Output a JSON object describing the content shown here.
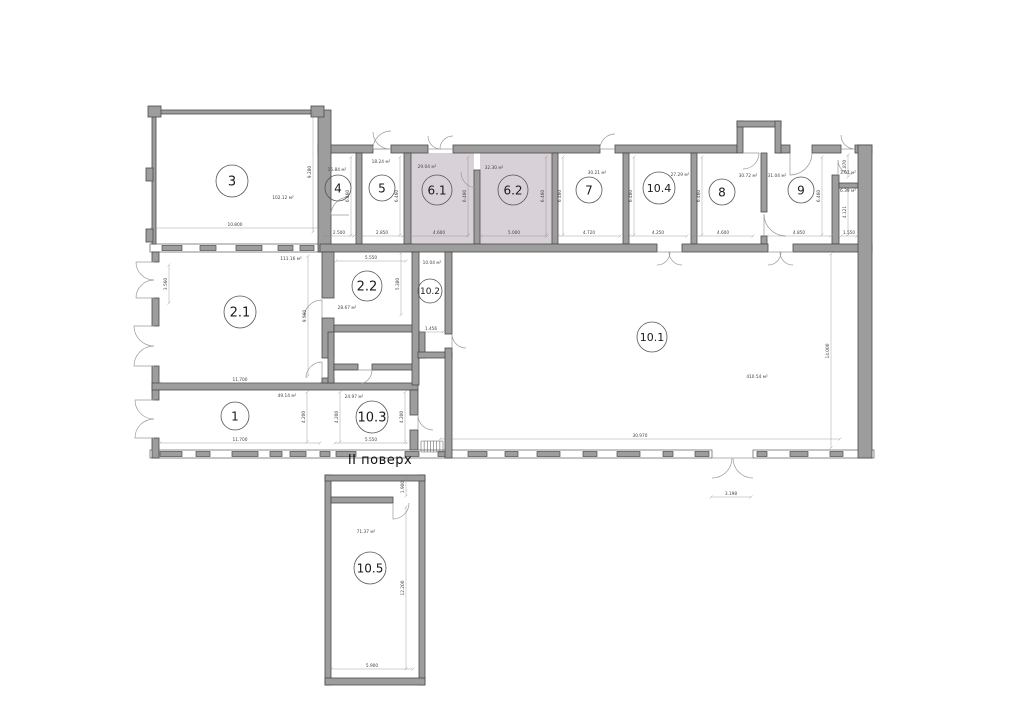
{
  "plan": {
    "floor_label": "II поверх",
    "colors": {
      "wall": "#9d9d9d",
      "wall_stroke": "#4a4a4a",
      "highlight": "#d9d1d8",
      "band_fill": "#ffffff",
      "band_stroke": "#6f6f6f",
      "door": "#9a9a9a",
      "dim": "#444444",
      "room_stroke": "#555555",
      "text": "#1a1a1a"
    },
    "rooms": [
      {
        "number": "3",
        "area": "102.12 м²",
        "circle": [
          232,
          181,
          16,
          13
        ],
        "area_pos": [
          283,
          199
        ]
      },
      {
        "number": "4",
        "area": "15.84 м²",
        "circle": [
          338,
          188,
          13,
          12
        ],
        "area_pos": [
          337,
          171
        ]
      },
      {
        "number": "5",
        "area": "18.24 м²",
        "circle": [
          382,
          188,
          13,
          12
        ],
        "area_pos": [
          381,
          163
        ]
      },
      {
        "number": "6.1",
        "area": "29.04 м²",
        "circle": [
          437,
          190,
          15,
          12
        ],
        "area_pos": [
          427,
          168
        ]
      },
      {
        "number": "6.2",
        "area": "32.30 м²",
        "circle": [
          513,
          190,
          15,
          12
        ],
        "area_pos": [
          494,
          169
        ]
      },
      {
        "number": "7",
        "area": "30.21 м²",
        "circle": [
          589,
          190,
          13,
          12
        ],
        "area_pos": [
          597,
          174
        ]
      },
      {
        "number": "10.4",
        "area": "27.29 м²",
        "circle": [
          659,
          188,
          16,
          11
        ],
        "area_pos": [
          680,
          176
        ]
      },
      {
        "number": "8",
        "area": "30.72 м²",
        "circle": [
          722,
          192,
          13,
          12
        ],
        "area_pos": [
          748,
          177
        ]
      },
      {
        "number": "9",
        "area": "31.04 м²",
        "circle": [
          801,
          190,
          13,
          12
        ],
        "area_pos": [
          777,
          177
        ]
      },
      {
        "number": "2.1",
        "area": "111.16 м²",
        "circle": [
          240,
          312,
          16,
          13
        ],
        "area_pos": [
          291,
          260
        ]
      },
      {
        "number": "2.2",
        "area": "28.67 м²",
        "circle": [
          367,
          286,
          15,
          13
        ],
        "area_pos": [
          347,
          309
        ]
      },
      {
        "number": "10.2",
        "area": "10.04 м²",
        "circle": [
          430,
          291,
          12,
          9
        ],
        "area_pos": [
          432,
          264
        ]
      },
      {
        "number": "1",
        "area": "49.14 м²",
        "circle": [
          235,
          416,
          14,
          12
        ],
        "area_pos": [
          287,
          397
        ]
      },
      {
        "number": "10.3",
        "area": "24.97 м²",
        "circle": [
          372,
          417,
          16,
          13
        ],
        "area_pos": [
          354,
          398
        ]
      },
      {
        "number": "10.1",
        "area": "410.54 м²",
        "circle": [
          652,
          337,
          15,
          11
        ],
        "area_pos": [
          757,
          378
        ]
      },
      {
        "number": "10.5",
        "area": "71.37 м²",
        "circle": [
          370,
          568,
          16,
          12
        ],
        "area_pos": [
          366,
          533
        ]
      }
    ],
    "extra_areas": [
      {
        "area": "3.07 м²",
        "pos": [
          848,
          174
        ]
      },
      {
        "area": "6.39 м²",
        "pos": [
          848,
          192
        ]
      }
    ],
    "fills": [
      [
        411,
        153,
        63,
        91
      ],
      [
        480,
        153,
        72,
        91
      ]
    ],
    "walls": [
      [
        318,
        145,
        55,
        8
      ],
      [
        391,
        145,
        37,
        8
      ],
      [
        453,
        145,
        147,
        8
      ],
      [
        615,
        145,
        122,
        8
      ],
      [
        777,
        145,
        13,
        8
      ],
      [
        812,
        145,
        29,
        8
      ],
      [
        855,
        145,
        17,
        8
      ],
      [
        737,
        121,
        6,
        32
      ],
      [
        737,
        121,
        44,
        6
      ],
      [
        775,
        121,
        6,
        32
      ],
      [
        356,
        153,
        6,
        91
      ],
      [
        404,
        153,
        7,
        91
      ],
      [
        474,
        170,
        6,
        74
      ],
      [
        552,
        153,
        6,
        91
      ],
      [
        623,
        153,
        6,
        91
      ],
      [
        691,
        153,
        6,
        91
      ],
      [
        761,
        153,
        6,
        59
      ],
      [
        761,
        236,
        6,
        8
      ],
      [
        832,
        175,
        7,
        69
      ],
      [
        839,
        183,
        19,
        5
      ],
      [
        318,
        110,
        13,
        142
      ],
      [
        152,
        110,
        166,
        4
      ],
      [
        152,
        114,
        4,
        130
      ],
      [
        148,
        106,
        13,
        11
      ],
      [
        311,
        106,
        13,
        11
      ],
      [
        146,
        168,
        7,
        13
      ],
      [
        146,
        229,
        7,
        13
      ],
      [
        320,
        244,
        337,
        8
      ],
      [
        682,
        244,
        86,
        8
      ],
      [
        793,
        244,
        79,
        8
      ],
      [
        152,
        252,
        7,
        10
      ],
      [
        152,
        298,
        7,
        28
      ],
      [
        152,
        366,
        7,
        34
      ],
      [
        152,
        438,
        7,
        20
      ],
      [
        152,
        383,
        266,
        7
      ],
      [
        322,
        252,
        12,
        46
      ],
      [
        322,
        318,
        12,
        40
      ],
      [
        322,
        378,
        12,
        5
      ],
      [
        328,
        332,
        6,
        51
      ],
      [
        334,
        364,
        24,
        6
      ],
      [
        372,
        364,
        46,
        6
      ],
      [
        334,
        325,
        84,
        7
      ],
      [
        412,
        252,
        7,
        133
      ],
      [
        419,
        332,
        6,
        26
      ],
      [
        418,
        352,
        34,
        6
      ],
      [
        445,
        252,
        7,
        82
      ],
      [
        445,
        348,
        7,
        110
      ],
      [
        410,
        390,
        8,
        25
      ],
      [
        410,
        430,
        8,
        20
      ],
      [
        858,
        145,
        14,
        313
      ],
      [
        325,
        475,
        6,
        210
      ],
      [
        419,
        475,
        6,
        210
      ],
      [
        325,
        475,
        100,
        6
      ],
      [
        325,
        678,
        100,
        7
      ],
      [
        331,
        497,
        62,
        6
      ]
    ],
    "bands": [
      [
        150,
        244,
        170,
        8
      ],
      [
        150,
        450,
        562,
        8
      ],
      [
        753,
        450,
        121,
        8
      ]
    ],
    "windows": [
      [
        162,
        245.5,
        20,
        5
      ],
      [
        200,
        245.5,
        16,
        5
      ],
      [
        236,
        245.5,
        26,
        5
      ],
      [
        278,
        245.5,
        15,
        5
      ],
      [
        300,
        245.5,
        14,
        5
      ],
      [
        160,
        451.5,
        22,
        5
      ],
      [
        196,
        451.5,
        14,
        5
      ],
      [
        232,
        451.5,
        26,
        5
      ],
      [
        270,
        451.5,
        12,
        5
      ],
      [
        290,
        451.5,
        16,
        5
      ],
      [
        320,
        451.5,
        10,
        5
      ],
      [
        336,
        451.5,
        20,
        5
      ],
      [
        405,
        451.5,
        14,
        5
      ],
      [
        438,
        451.5,
        13,
        5
      ],
      [
        468,
        451.5,
        19,
        5
      ],
      [
        505,
        451.5,
        13,
        5
      ],
      [
        537,
        451.5,
        23,
        5
      ],
      [
        583,
        451.5,
        14,
        5
      ],
      [
        617,
        451.5,
        23,
        5
      ],
      [
        663,
        451.5,
        10,
        5
      ],
      [
        695,
        451.5,
        14,
        5
      ],
      [
        757,
        451.5,
        10,
        5
      ],
      [
        790,
        451.5,
        18,
        5
      ],
      [
        830,
        451.5,
        13,
        5
      ]
    ],
    "arcs": [
      [
        154,
        262,
        18,
        180,
        90
      ],
      [
        154,
        298,
        18,
        180,
        270
      ],
      [
        154,
        326,
        20,
        180,
        90
      ],
      [
        154,
        366,
        20,
        180,
        270
      ],
      [
        154,
        400,
        19,
        180,
        90
      ],
      [
        154,
        438,
        19,
        180,
        270
      ],
      [
        373,
        149,
        17,
        0,
        270
      ],
      [
        391,
        149,
        18,
        180,
        270
      ],
      [
        428,
        149,
        13,
        0,
        270
      ],
      [
        453,
        149,
        13,
        180,
        270
      ],
      [
        615,
        149,
        15,
        180,
        270
      ],
      [
        841,
        149,
        14,
        0,
        270
      ],
      [
        743,
        153,
        16,
        0,
        90
      ],
      [
        657,
        252,
        13,
        0,
        90
      ],
      [
        682,
        252,
        13,
        180,
        90
      ],
      [
        768,
        252,
        13,
        0,
        90
      ],
      [
        793,
        252,
        13,
        180,
        90
      ],
      [
        712,
        458,
        20,
        0,
        90
      ],
      [
        753,
        458,
        20,
        180,
        90
      ],
      [
        349,
        215,
        18,
        180,
        270
      ],
      [
        322,
        318,
        18,
        270,
        180
      ],
      [
        322,
        378,
        16,
        270,
        180
      ],
      [
        358,
        370,
        14,
        0,
        90
      ],
      [
        452,
        348,
        14,
        270,
        0
      ],
      [
        418,
        430,
        15,
        270,
        0
      ],
      [
        790,
        153,
        22,
        90,
        0
      ],
      [
        838,
        174,
        14,
        270,
        0
      ],
      [
        477,
        172,
        16,
        90,
        180
      ],
      [
        393,
        503,
        16,
        90,
        0
      ],
      [
        764,
        236,
        22,
        270,
        0
      ]
    ],
    "dims": [
      {
        "t": "10.800",
        "x": 235,
        "y": 226,
        "len": 168,
        "v": false
      },
      {
        "t": "9.280",
        "x": 311,
        "y": 172,
        "len": 120,
        "v": true
      },
      {
        "t": "2.500",
        "x": 339,
        "y": 234,
        "len": 30,
        "v": false
      },
      {
        "t": "2.850",
        "x": 382,
        "y": 234,
        "len": 42,
        "v": false
      },
      {
        "t": "4.600",
        "x": 439,
        "y": 234,
        "len": 58,
        "v": false
      },
      {
        "t": "5.000",
        "x": 514,
        "y": 234,
        "len": 66,
        "v": false
      },
      {
        "t": "4.720",
        "x": 589,
        "y": 234,
        "len": 62,
        "v": false
      },
      {
        "t": "4.250",
        "x": 658,
        "y": 234,
        "len": 58,
        "v": false
      },
      {
        "t": "4.600",
        "x": 723,
        "y": 234,
        "len": 60,
        "v": false
      },
      {
        "t": "4.850",
        "x": 799,
        "y": 234,
        "len": 64,
        "v": false
      },
      {
        "t": "1.550",
        "x": 849,
        "y": 234,
        "len": 16,
        "v": false
      },
      {
        "t": "6.460",
        "x": 349,
        "y": 196,
        "len": 78,
        "v": true
      },
      {
        "t": "6.460",
        "x": 398,
        "y": 196,
        "len": 78,
        "v": true
      },
      {
        "t": "6.460",
        "x": 466,
        "y": 196,
        "len": 78,
        "v": true
      },
      {
        "t": "6.460",
        "x": 544,
        "y": 196,
        "len": 78,
        "v": true
      },
      {
        "t": "6.460",
        "x": 561,
        "y": 196,
        "len": 78,
        "v": true
      },
      {
        "t": "6.460",
        "x": 632,
        "y": 196,
        "len": 78,
        "v": true
      },
      {
        "t": "6.460",
        "x": 700,
        "y": 196,
        "len": 78,
        "v": true
      },
      {
        "t": "6.460",
        "x": 820,
        "y": 196,
        "len": 78,
        "v": true
      },
      {
        "t": "1.870",
        "x": 846,
        "y": 166,
        "len": 22,
        "v": true
      },
      {
        "t": "4.121",
        "x": 846,
        "y": 212,
        "len": 46,
        "v": true
      },
      {
        "t": "11.700",
        "x": 240,
        "y": 381,
        "len": 160,
        "v": false
      },
      {
        "t": "9.560",
        "x": 306,
        "y": 316,
        "len": 120,
        "v": true
      },
      {
        "t": "3.560",
        "x": 167,
        "y": 284,
        "len": 38,
        "v": true
      },
      {
        "t": "5.550",
        "x": 371,
        "y": 259,
        "len": 70,
        "v": false
      },
      {
        "t": "5.380",
        "x": 399,
        "y": 284,
        "len": 62,
        "v": true
      },
      {
        "t": "1.456",
        "x": 431,
        "y": 330,
        "len": 24,
        "v": false
      },
      {
        "t": "11.700",
        "x": 240,
        "y": 441,
        "len": 160,
        "v": false
      },
      {
        "t": "4.200",
        "x": 305,
        "y": 417,
        "len": 50,
        "v": true
      },
      {
        "t": "4.200",
        "x": 338,
        "y": 417,
        "len": 50,
        "v": true
      },
      {
        "t": "4.200",
        "x": 403,
        "y": 417,
        "len": 50,
        "v": true
      },
      {
        "t": "5.550",
        "x": 371,
        "y": 441,
        "len": 72,
        "v": false
      },
      {
        "t": "30.970",
        "x": 640,
        "y": 437,
        "len": 400,
        "v": false
      },
      {
        "t": "14.000",
        "x": 829,
        "y": 351,
        "len": 194,
        "v": true
      },
      {
        "t": "3.198",
        "x": 731,
        "y": 495,
        "len": 40,
        "v": false
      },
      {
        "t": "5.900",
        "x": 372,
        "y": 667,
        "len": 82,
        "v": false
      },
      {
        "t": "12.200",
        "x": 404,
        "y": 588,
        "len": 162,
        "v": true
      },
      {
        "t": "1.900",
        "x": 404,
        "y": 487,
        "len": 18,
        "v": true
      }
    ],
    "hatch": {
      "x": 421,
      "y": 441,
      "w": 22,
      "h": 11,
      "n": 8
    }
  }
}
